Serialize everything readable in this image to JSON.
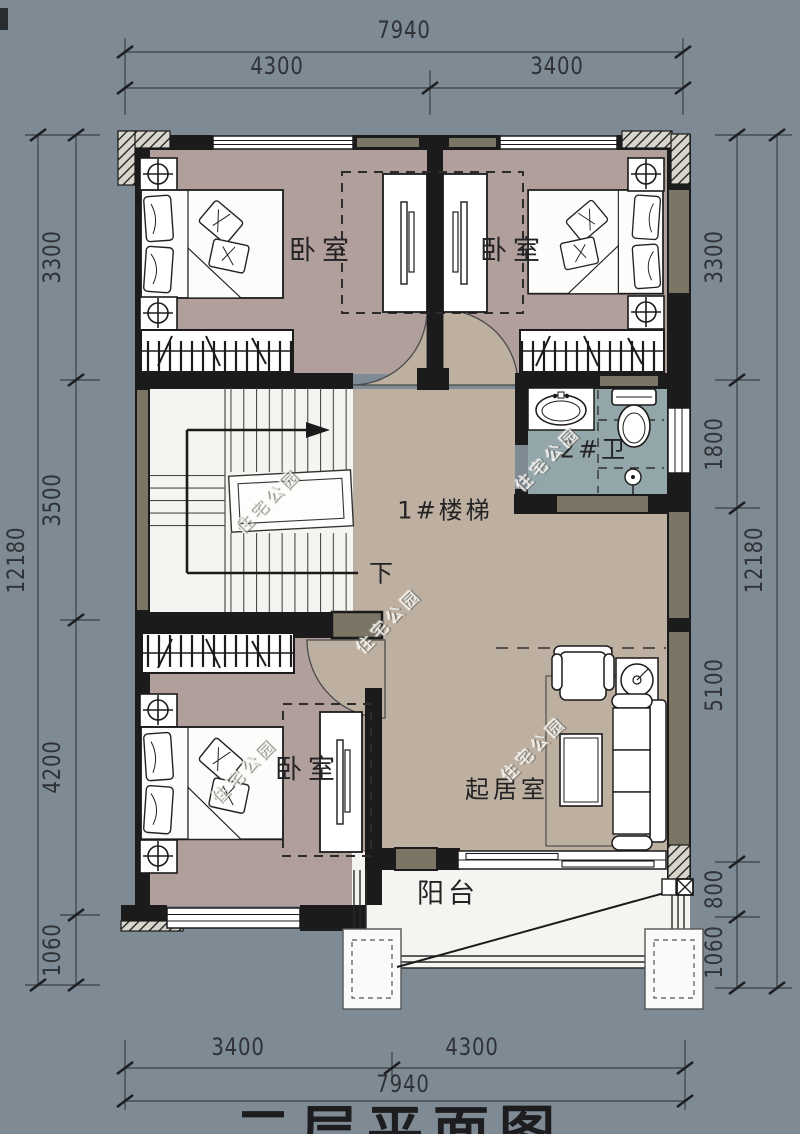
{
  "colors": {
    "background": "#7e8a94",
    "wall": "#1b1b1b",
    "wall_fill": "#7b7566",
    "floor_bedroom": "#b19f9b",
    "floor_hall": "#bdb0a0",
    "floor_bath": "#93a6aa",
    "floor_light": "#f4f4f1",
    "dim_line": "#3c4046",
    "watermark_text": "#f0eee8"
  },
  "rooms": {
    "bedroom_top_left": {
      "label": "卧室"
    },
    "bedroom_top_right": {
      "label": "卧室"
    },
    "bathroom": {
      "label": "2#卫"
    },
    "staircase": {
      "label": "1#楼梯"
    },
    "stair_direction": {
      "label": "下"
    },
    "bedroom_bottom_left": {
      "label": "卧室"
    },
    "living_room": {
      "label": "起居室"
    },
    "balcony": {
      "label": "阳台"
    }
  },
  "dimensions": {
    "top": {
      "overall": "7940",
      "segments": [
        "4300",
        "3400"
      ]
    },
    "bottom": {
      "overall": "7940",
      "segments": [
        "3400",
        "4300"
      ]
    },
    "left": {
      "overall": "12180",
      "segments": [
        "3300",
        "3500",
        "4200",
        "1060"
      ]
    },
    "right": {
      "overall": "12180",
      "segments": [
        "3300",
        "1800",
        "5100",
        "800",
        "1060"
      ]
    }
  },
  "title": {
    "text": "二层平面图"
  },
  "watermark": {
    "text": "住宅公园"
  }
}
